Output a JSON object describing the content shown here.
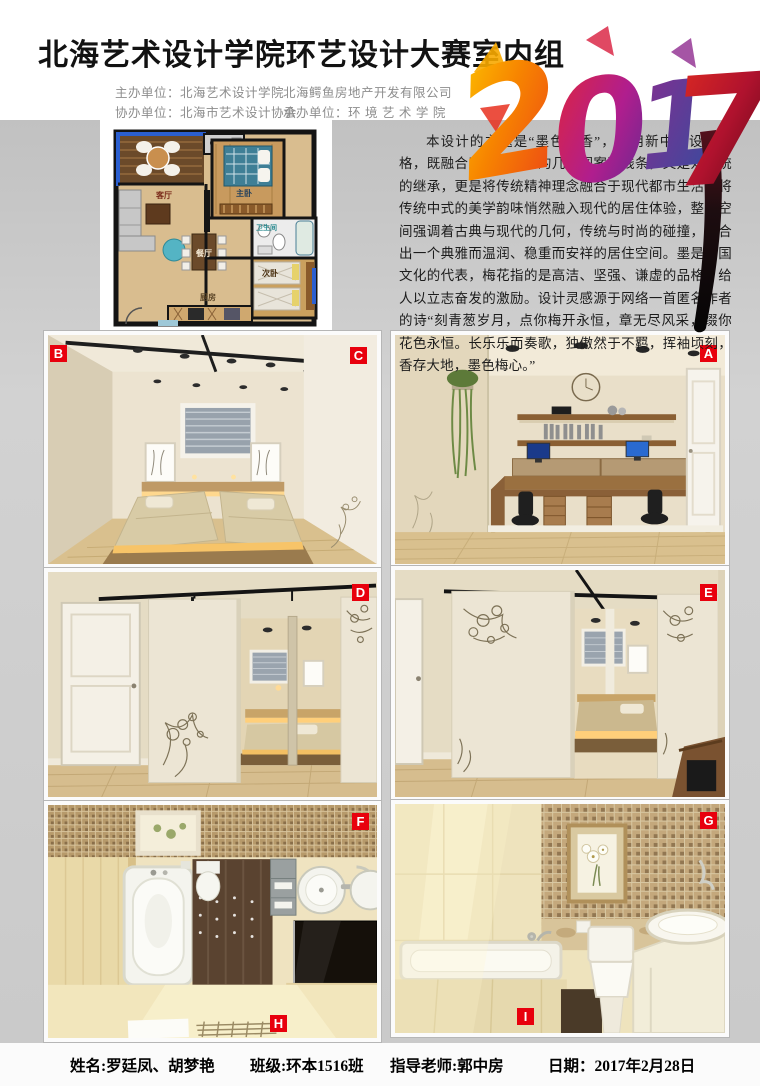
{
  "colors": {
    "accent_red": "#e8000d",
    "body_gray": "#cacaca",
    "header_bg": "#ffffff",
    "footer_bg": "#fbfbfb",
    "year_orange": "#f7a800",
    "year_magenta": "#c0168c",
    "year_purple": "#5b2a8e",
    "year_crimson": "#d81b3c"
  },
  "header": {
    "title": "北海艺术设计学院环艺设计大赛室内组",
    "year": "2017",
    "year_digits": [
      "2",
      "0",
      "1",
      "7"
    ],
    "orgs": {
      "row1_left": "主办单位：北海艺术设计学院",
      "row1_right": "北海鳄鱼房地产开发有限公司",
      "row2_left": "协办单位：北海市艺术设计协会",
      "row2_right": "承办单位：环 境 艺 术 学 院"
    }
  },
  "intro": {
    "text": "本设计的主题是“墨色梅香”，采用新中式设计风格，既融合了现代简约的几何图案及线条，又是对传统的继承，更是将传统精神理念融合于现代都市生活，将传统中式的美学韵味悄然融入现代的居住体验，整个空间强调着古典与现代的几何，传统与时尚的碰撞，整合出一个典雅而温润、稳重而安祥的居住空间。墨是中国文化的代表，梅花指的是高洁、坚强、谦虚的品格，给人以立志奋发的激励。设计灵感源于网络一首匿名作者的诗“刻青葱岁月，点你梅开永恒，章无尽风采，缀你花色永恒。长乐乐而奏歌，独傲然于不羁，挥袖顷刻，香存大地，墨色梅心。”"
  },
  "floorplan": {
    "rooms": {
      "living": "客厅",
      "dining": "餐厅",
      "master": "主卧",
      "bath": "卫生间",
      "second": "次卧",
      "kitchen": "厨房"
    }
  },
  "markers": {
    "a": "A",
    "b": "B",
    "c": "C",
    "d": "D",
    "e": "E",
    "f": "F",
    "g": "G",
    "h": "H",
    "i": "I"
  },
  "footer": {
    "name": "姓名:罗廷凤、胡梦艳",
    "class": "班级:环本1516班",
    "teacher": "指导老师:郭中房",
    "date": "日期：2017年2月28日"
  }
}
